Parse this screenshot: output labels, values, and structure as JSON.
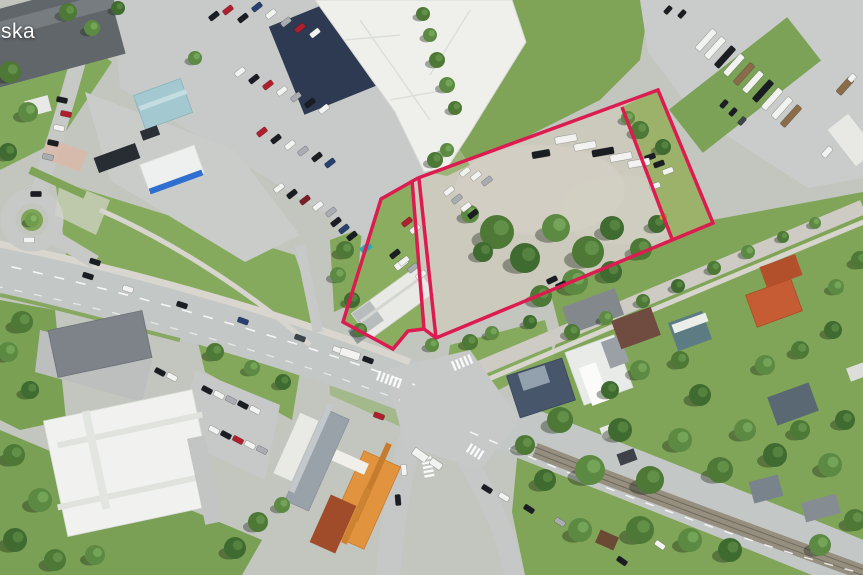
{
  "map": {
    "type": "satellite-aerial-view",
    "label": "ska",
    "overlay": {
      "stroke_color": "#dc1c50",
      "stroke_width": 3.5,
      "shapes": [
        {
          "name": "parcel-outline",
          "points": [
            [
              418,
              178
            ],
            [
              658,
              90
            ],
            [
              713,
              223
            ],
            [
              436,
              338
            ],
            [
              424,
              329
            ],
            [
              408,
              331
            ],
            [
              393,
              349
            ],
            [
              343,
              322
            ],
            [
              381,
              199
            ],
            [
              418,
              178
            ]
          ]
        },
        {
          "name": "inner-divider",
          "points": [
            [
              622,
              107
            ],
            [
              672,
              239
            ]
          ]
        },
        {
          "name": "corridor-left",
          "points": [
            [
              412,
              180
            ],
            [
              424,
              329
            ]
          ]
        },
        {
          "name": "corridor-right",
          "points": [
            [
              419,
              179
            ],
            [
              436,
              338
            ]
          ]
        }
      ]
    },
    "palette": {
      "grass": "#7fa457",
      "asphalt": "#c7cac8",
      "gravel": "#ccc9bd",
      "road": "#c3c7c5",
      "building_white": "#f0f1ee",
      "shadow_navy": "#2e3a52",
      "boundary": "#dc1c50"
    }
  }
}
